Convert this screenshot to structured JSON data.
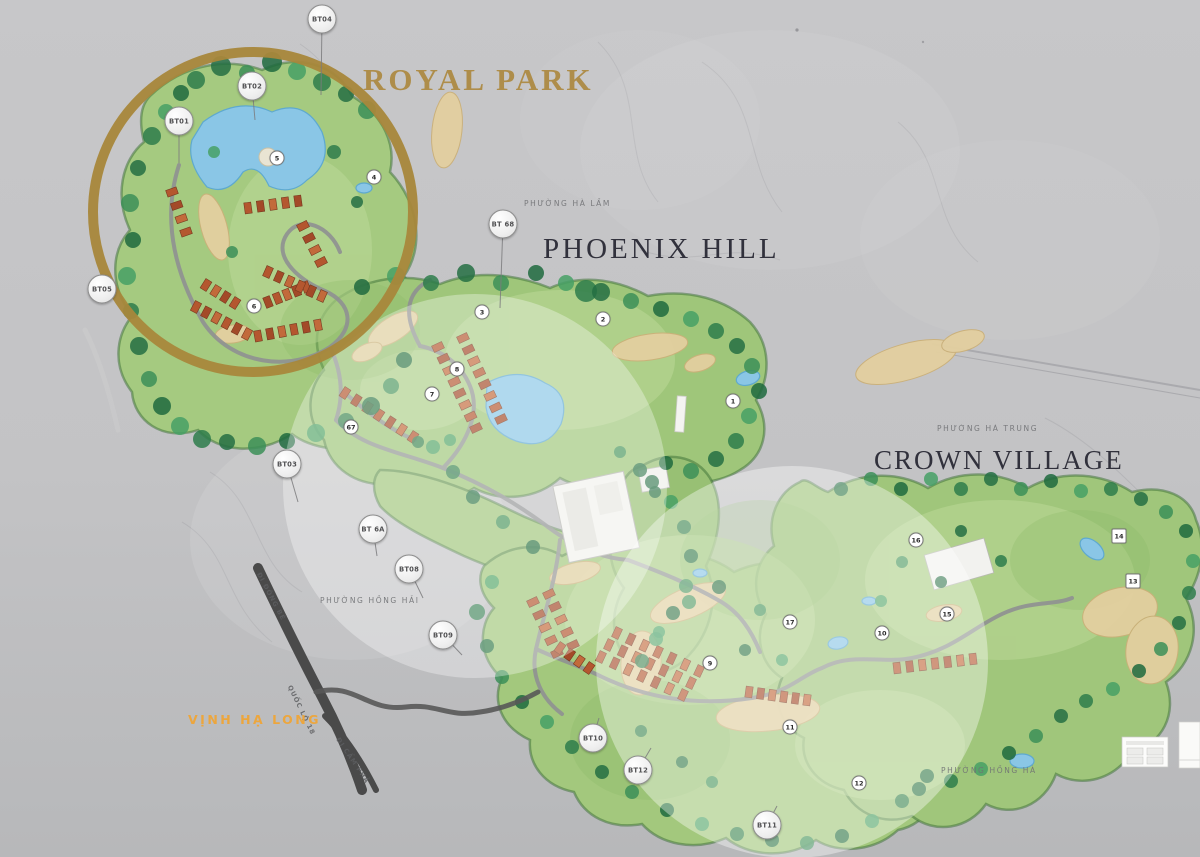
{
  "zones": {
    "royal_park": {
      "label": "ROYAL PARK",
      "color": "#ae8d4a"
    },
    "phoenix_hill": {
      "label": "PHOENIX HILL",
      "color": "#31313c"
    },
    "crown_village": {
      "label": "CROWN VILLAGE",
      "color": "#31313c"
    }
  },
  "district_labels": [
    {
      "label": "PHƯỜNG HÀ LẦM",
      "x": 524,
      "y": 199
    },
    {
      "label": "PHƯỜNG HÀ TRUNG",
      "x": 937,
      "y": 424
    },
    {
      "label": "PHƯỜNG HỒNG HẢI",
      "x": 320,
      "y": 596
    },
    {
      "label": "PHƯỜNG HỒNG HÀ",
      "x": 941,
      "y": 766
    }
  ],
  "road_labels": [
    {
      "label": "ĐI ĐÔNG BỀ",
      "x": 262,
      "y": 571,
      "rotate": 62
    },
    {
      "label": "QUỐC LỘ 18",
      "x": 293,
      "y": 684,
      "rotate": 64
    },
    {
      "label": "ĐI CẨM PHẢ",
      "x": 341,
      "y": 736,
      "rotate": 56
    }
  ],
  "water_label": {
    "label": "VỊNH HẠ LONG",
    "color": "#eca63e",
    "x": 188,
    "y": 712
  },
  "bt_markers": [
    {
      "label": "BT04",
      "x": 322,
      "y": 19,
      "lx": 321,
      "ly": 95
    },
    {
      "label": "BT02",
      "x": 252,
      "y": 86,
      "lx": 255,
      "ly": 120
    },
    {
      "label": "BT01",
      "x": 179,
      "y": 121,
      "lx": 179,
      "ly": 163
    },
    {
      "label": "BT05",
      "x": 102,
      "y": 289
    },
    {
      "label": "BT 68",
      "x": 503,
      "y": 224,
      "lx": 500,
      "ly": 308
    },
    {
      "label": "BT03",
      "x": 287,
      "y": 464,
      "lx": 298,
      "ly": 502
    },
    {
      "label": "BT 6A",
      "x": 373,
      "y": 529,
      "lx": 377,
      "ly": 556
    },
    {
      "label": "BT08",
      "x": 409,
      "y": 569,
      "lx": 423,
      "ly": 598
    },
    {
      "label": "BT09",
      "x": 443,
      "y": 635,
      "lx": 462,
      "ly": 655
    },
    {
      "label": "BT10",
      "x": 593,
      "y": 738,
      "lx": 599,
      "ly": 718
    },
    {
      "label": "BT12",
      "x": 638,
      "y": 770,
      "lx": 651,
      "ly": 748
    },
    {
      "label": "BT11",
      "x": 767,
      "y": 825,
      "lx": 777,
      "ly": 806
    }
  ],
  "hole_markers": [
    {
      "label": "5",
      "x": 277,
      "y": 158
    },
    {
      "label": "4",
      "x": 374,
      "y": 177
    },
    {
      "label": "6",
      "x": 254,
      "y": 306
    },
    {
      "label": "3",
      "x": 482,
      "y": 312
    },
    {
      "label": "2",
      "x": 603,
      "y": 319
    },
    {
      "label": "1",
      "x": 733,
      "y": 401
    },
    {
      "label": "8",
      "x": 457,
      "y": 369
    },
    {
      "label": "7",
      "x": 432,
      "y": 394
    },
    {
      "label": "67",
      "x": 351,
      "y": 427
    },
    {
      "label": "9",
      "x": 710,
      "y": 663
    },
    {
      "label": "17",
      "x": 790,
      "y": 622
    },
    {
      "label": "10",
      "x": 882,
      "y": 633
    },
    {
      "label": "15",
      "x": 947,
      "y": 614
    },
    {
      "label": "16",
      "x": 916,
      "y": 540
    },
    {
      "label": "14",
      "x": 1119,
      "y": 536,
      "shape": "square"
    },
    {
      "label": "13",
      "x": 1133,
      "y": 581,
      "shape": "square"
    },
    {
      "label": "11",
      "x": 790,
      "y": 727
    },
    {
      "label": "12",
      "x": 859,
      "y": 783
    }
  ],
  "colors": {
    "gold_ring": "#a8873b",
    "land": "#a3c87e",
    "sand": "#e3cfa0",
    "water": "#8ac6e6",
    "road_dark": "#4a4a4a",
    "road_light": "#8f9092",
    "highlight_circle": "#ffffff"
  }
}
